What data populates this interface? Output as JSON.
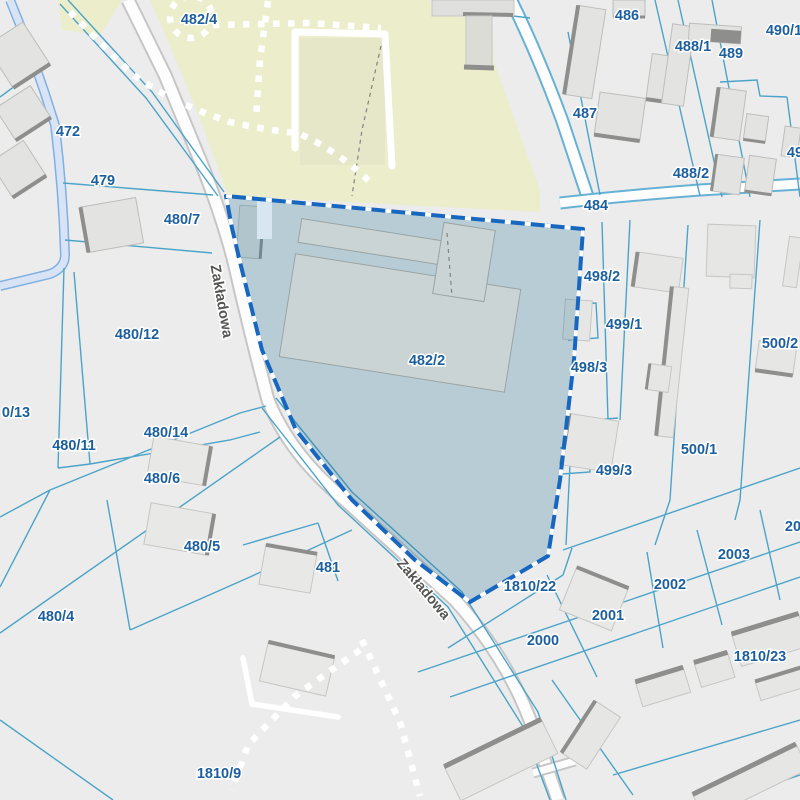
{
  "map": {
    "type": "cadastral-parcel-map",
    "selected_parcel": {
      "id": "482/2",
      "outline_color": "#1767c0",
      "fill_overlay": "rgba(45,118,152,0.27)"
    },
    "colors": {
      "background": "#ececec",
      "park_area": "#ecedcb",
      "parcel_line": "#4ba4c8",
      "road_fill": "#fdfdfd",
      "road_casing": "#c6c6c6",
      "building_fill": "#e3e3e1",
      "building_shadow": "#8e8e8c",
      "ditch_band": "#d8e4f5",
      "ditch_edge": "#7fb0e2",
      "label_color": "#1c5f9e",
      "street_label_color": "#555553"
    }
  },
  "labels": [
    {
      "t": "482/4"
    },
    {
      "t": "472"
    },
    {
      "t": "479"
    },
    {
      "t": "480/7"
    },
    {
      "t": "480/12"
    },
    {
      "t": "0/13"
    },
    {
      "t": "480/11"
    },
    {
      "t": "480/14"
    },
    {
      "t": "480/6"
    },
    {
      "t": "480/5"
    },
    {
      "t": "481"
    },
    {
      "t": "480/4"
    },
    {
      "t": "1810/9"
    },
    {
      "t": "482/2"
    },
    {
      "t": "484"
    },
    {
      "t": "486"
    },
    {
      "t": "488/1"
    },
    {
      "t": "489"
    },
    {
      "t": "490/1"
    },
    {
      "t": "487"
    },
    {
      "t": "488/2"
    },
    {
      "t": "49"
    },
    {
      "t": "498/2"
    },
    {
      "t": "499/1"
    },
    {
      "t": "498/3"
    },
    {
      "t": "500/2"
    },
    {
      "t": "500/1"
    },
    {
      "t": "499/3"
    },
    {
      "t": "1810/22"
    },
    {
      "t": "2000"
    },
    {
      "t": "2001"
    },
    {
      "t": "2002"
    },
    {
      "t": "2003"
    },
    {
      "t": "200"
    },
    {
      "t": "1810/23"
    }
  ],
  "street_labels": [
    {
      "t": "Zakładowa"
    },
    {
      "t": "Zakładowa"
    }
  ]
}
